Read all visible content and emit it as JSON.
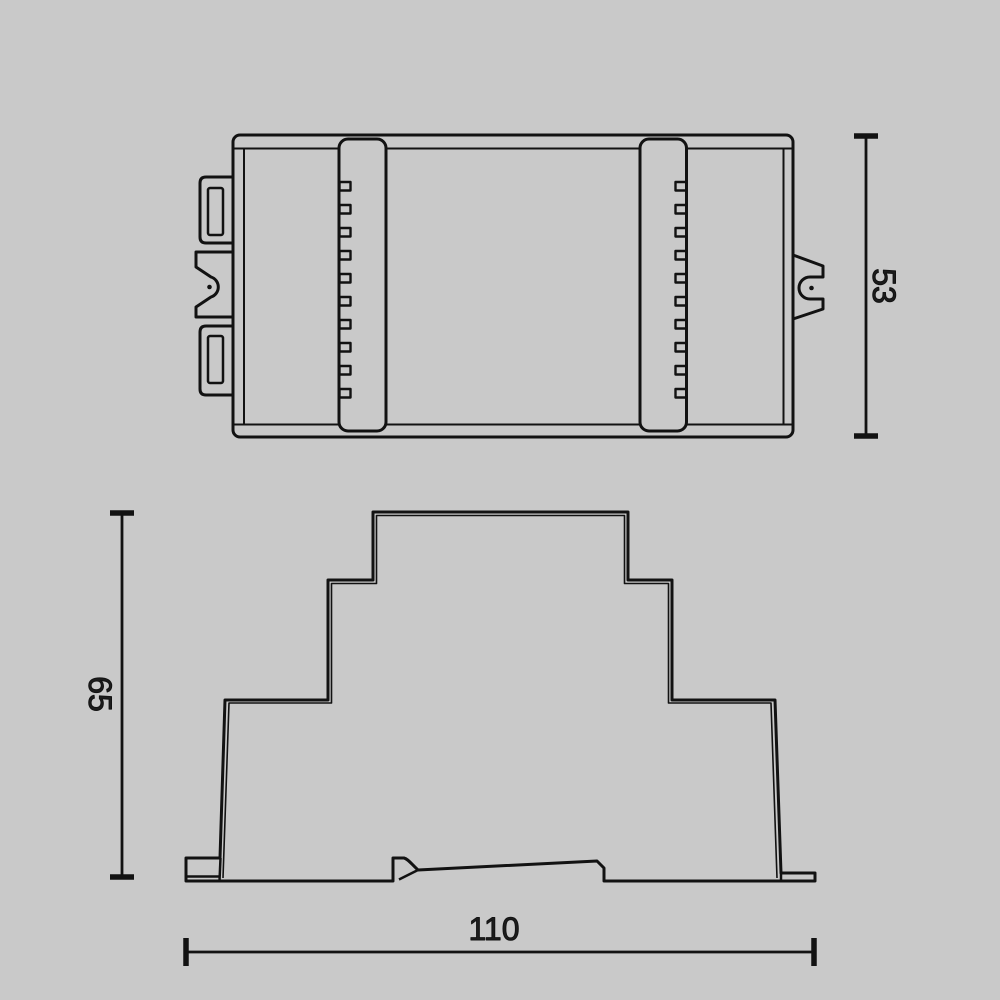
{
  "canvas": {
    "background": "#c9c9c9",
    "line_color": "#121212",
    "text_color": "#1c1c1c"
  },
  "drawing": {
    "description_visible_views": 2,
    "dimensions": {
      "top_view_height": {
        "value": "53",
        "orientation": "vertical"
      },
      "profile_view_height": {
        "value": "65",
        "orientation": "vertical"
      },
      "overall_width": {
        "value": "110",
        "orientation": "horizontal"
      }
    }
  }
}
